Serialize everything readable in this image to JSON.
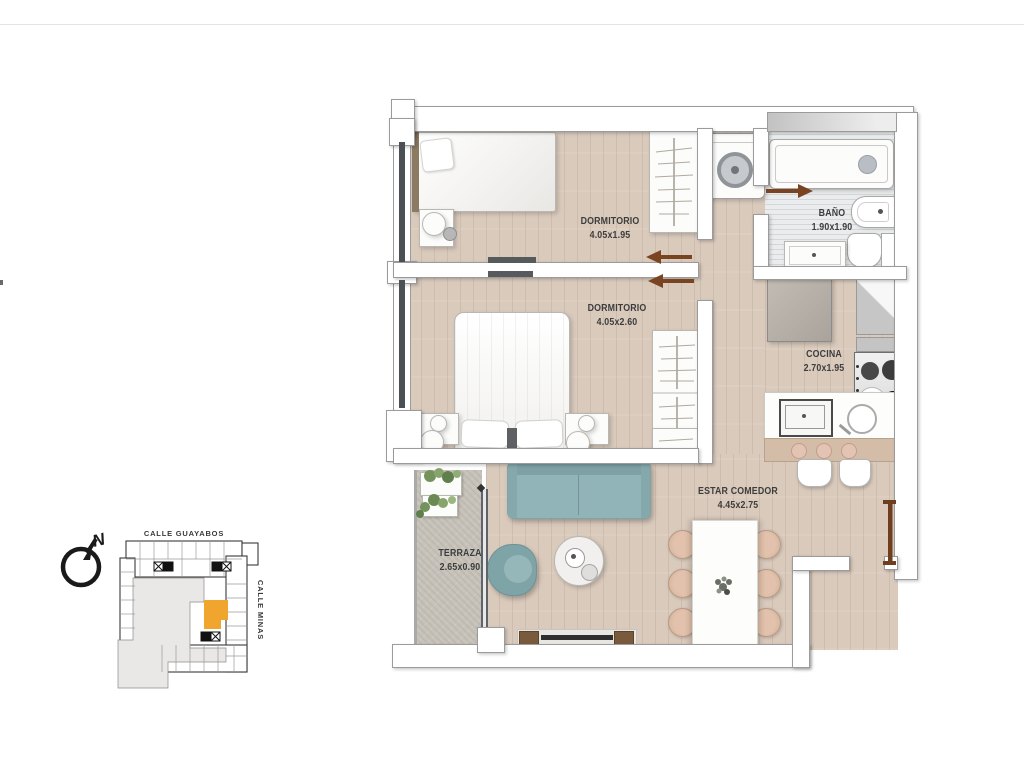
{
  "rooms": [
    {
      "name": "DORMITORIO",
      "dims": "4.05x1.95"
    },
    {
      "name": "DORMITORIO",
      "dims": "4.05x2.60"
    },
    {
      "name": "BAÑO",
      "dims": "1.90x1.90"
    },
    {
      "name": "COCINA",
      "dims": "2.70x1.95"
    },
    {
      "name": "ESTAR COMEDOR",
      "dims": "4.45x2.75"
    },
    {
      "name": "TERRAZA",
      "dims": "2.65x0.90"
    }
  ],
  "keyplan": {
    "street_top": "CALLE GUAYABOS",
    "street_right": "CALLE MINAS",
    "north_label": "N",
    "highlight_color": "#F0A52F"
  },
  "colors": {
    "wall_stroke": "#9B9B9B",
    "wood_floor": "#D9CABC",
    "terrace_floor": "#C7C3BA",
    "sofa_teal": "#8FB3B6",
    "chair_tan": "#DCB9A2",
    "door_brown": "#7A4423",
    "label_text": "#3D3D3D"
  }
}
